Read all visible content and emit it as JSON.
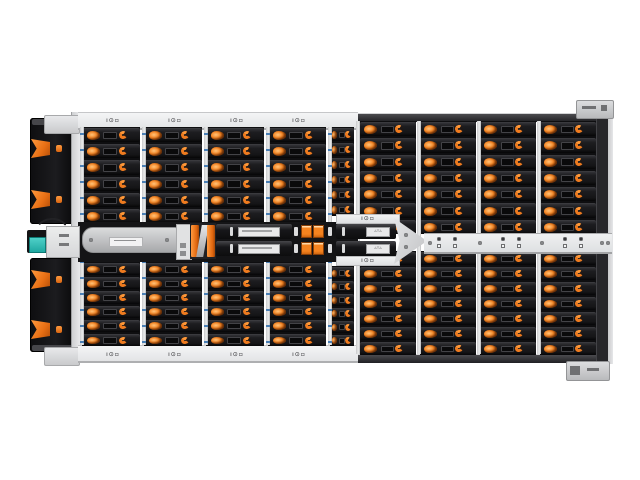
{
  "image": {
    "kind": "product-photo",
    "subject": "Top view of a 4U high-density JBOD storage enclosure with hot-swap drive rows, orange drive latches and black front bezel",
    "background_color": "#ffffff"
  },
  "colors": {
    "background": "#ffffff",
    "bezel_black": "#17171a",
    "accent_orange": "#f5821f",
    "drive_tray_dark": "#161618",
    "drive_slot_border": "#434347",
    "chassis_light_gray": "#e7e8ea",
    "rail_gray": "#eceded",
    "right_edge_dark": "#27272a",
    "qsfp_teal": "#2fbcb4",
    "screw_gray": "#88898b",
    "divider_dot_blue": "#4a7fb5"
  },
  "glyphs": {
    "rail_marker": "ı⊙▫",
    "canister_label": "▵▿▵"
  },
  "enclosure": {
    "left_section": {
      "columns": 4,
      "rows_top": 6,
      "rows_bottom": 6,
      "rail_markers_top": 4,
      "rail_markers_bottom": 4
    },
    "transition_column": {
      "rows_top": 6,
      "rows_bottom": 6,
      "marker_strips": 2
    },
    "right_section": {
      "columns": 4,
      "rows_top": 7,
      "rows_bottom": 7
    },
    "right_mid_rail": {
      "marker_pairs": 3,
      "screws": 5
    },
    "bezel": {
      "panels": 2,
      "latch_groups_per_panel": 2
    },
    "center_modules": [
      "qsfp-cable-module",
      "slide-rail",
      "control-module",
      "orange-latch-handle",
      "canister-pair-a",
      "orange-clip-block",
      "canister-pair-b",
      "divider-wedge"
    ]
  }
}
